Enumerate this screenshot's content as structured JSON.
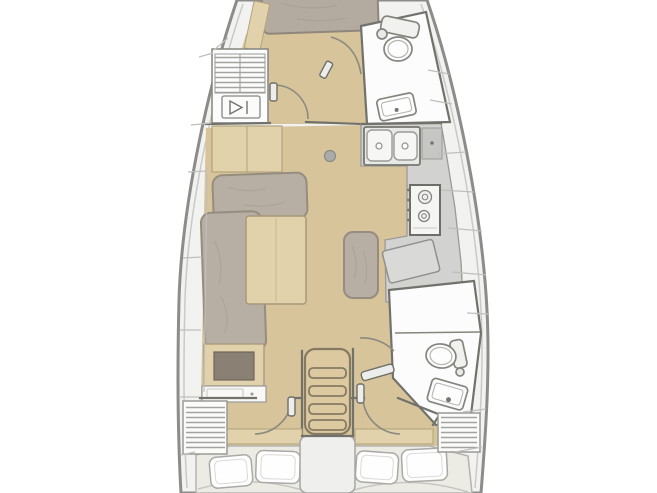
{
  "diagram": {
    "type": "floor-plan",
    "subject": "sailing-yacht-interior",
    "orientation": "bow-up",
    "rooms_visible": 7
  },
  "colors": {
    "page_bg": "#ffffff",
    "hull_outline": "#8c8c8a",
    "hull_inner_line": "#c9c9c7",
    "side_deck": "#f2f2f0",
    "wall": "#72726c",
    "wood_floor": "#d7c49b",
    "wood_cabinet": "#e2d2ac",
    "wood_edge": "#a8987a",
    "cushion": "#b7afa3",
    "cushion_edge": "#968d80",
    "v_berth": "#b3aaa0",
    "white_room": "#fcfcfc",
    "white_cabinet": "#f8f8f6",
    "fixture_edge": "#85857f",
    "counter": "#d2d2d0",
    "counter_dark": "#c6c6c4",
    "appliance_white": "#f5f5f4",
    "chart_table": "#d9d9d7",
    "pillow": "#fefefe",
    "pillow_edge": "#a9a9a7",
    "aft_bed": "#edece4",
    "aft_bed_edge": "#b3b3b1",
    "locker_hatch": "#a3a3a1",
    "door_arc": "#8b8b80",
    "ladder_wood": "#dcc9a0",
    "ladder_edge": "#857a63",
    "inset_dark": "#8a8174",
    "engine_hatch": "#efefed",
    "seam_line": "#bfbfbd",
    "post_gray": "#ababab"
  }
}
